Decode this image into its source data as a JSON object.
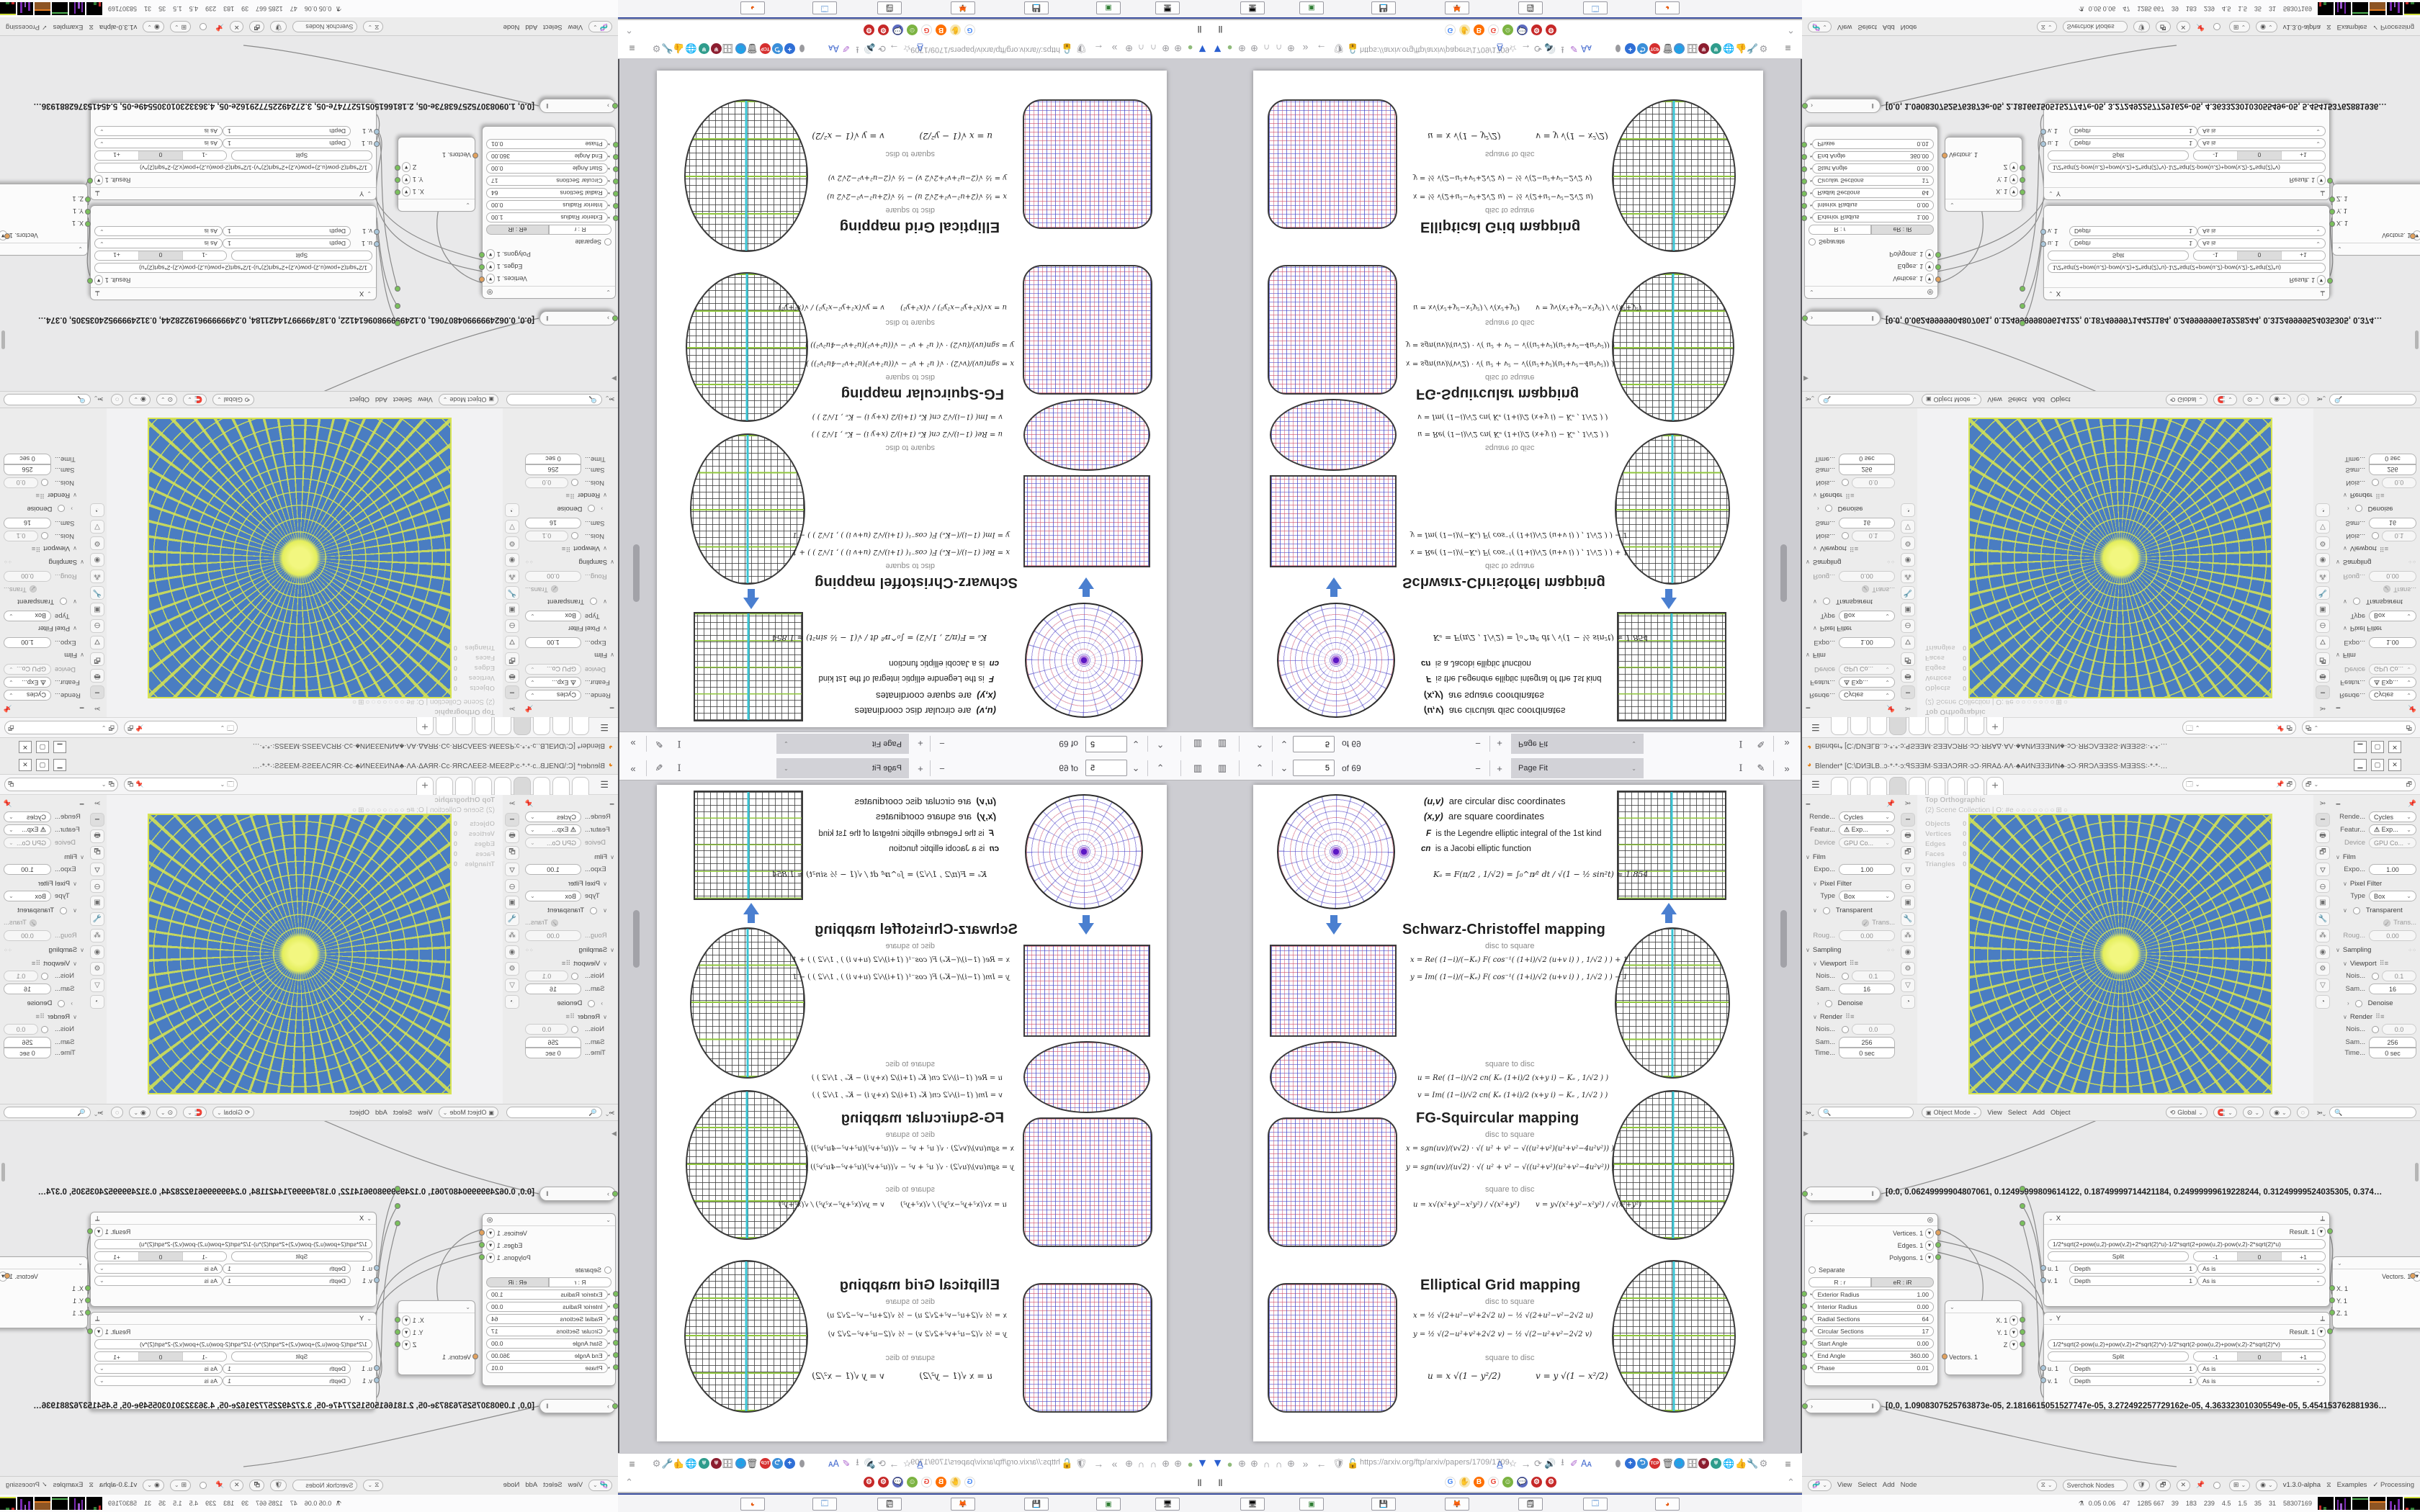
{
  "pdf": {
    "toolbar": {
      "page_value": "5",
      "page_total": "of 69",
      "zoom_mode": "Page Fit"
    },
    "url": "https://arxiv.org/ftp/arxiv/papers/1709/1709.",
    "paper": {
      "intro": [
        {
          "term": "(u,v)",
          "rest": "are circular disc coordinates"
        },
        {
          "term": "(x,y)",
          "rest": "are square coordinates"
        },
        {
          "term": "F",
          "rest": "is the Legendre elliptic integral of the 1st kind"
        },
        {
          "term": "cn",
          "rest": "is a Jacobi elliptic function"
        }
      ],
      "ke_equation": "Kₑ =  F(π∕2 , 1∕√2) = ∫₀^π⁄²  dt ∕ √(1 − ½ sin²t)  ≈ 1.854",
      "sections": [
        {
          "title": "Schwarz-Christoffel mapping",
          "d2s_label": "disc to square",
          "s2d_label": "square to disc",
          "d2s": [
            "x = Re( (1−i)∕(−Kₑ) F( cos⁻¹( (1+i)∕√2 (u+v i) ) , 1∕√2 ) ) + 1",
            "y = Im( (1−i)∕(−Kₑ) F( cos⁻¹( (1+i)∕√2 (u+v i) ) , 1∕√2 ) ) − 1"
          ],
          "s2d": [
            "u = Re( (1−i)∕√2  cn( Kₑ (1+i)∕2 (x+y i) − Kₑ , 1∕√2 ) )",
            "v = Im( (1−i)∕√2  cn( Kₑ (1+i)∕2 (x+y i) − Kₑ , 1∕√2 ) )"
          ]
        },
        {
          "title": "FG-Squircular mapping",
          "d2s_label": "disc to square",
          "s2d_label": "square to disc",
          "d2s": [
            "x = sgn(uv)∕(v√2) · √( u² + v² − √((u²+v²)(u²+v²−4u²v²)) )",
            "y = sgn(uv)∕(u√2) · √( u² + v² − √((u²+v²)(u²+v²−4u²v²)) )"
          ],
          "s2d": [
            "u = x√(x²+y²−x²y²) ∕ √(x²+y²)",
            "v = y√(x²+y²−x²y²) ∕ √(x²+y²)"
          ]
        },
        {
          "title": "Elliptical Grid mapping",
          "d2s_label": "disc to square",
          "s2d_label": "square to disc",
          "d2s": [
            "x = ½ √(2+u²−v²+2√2 u)  −  ½ √(2+u²−v²−2√2 u)",
            "y = ½ √(2−u²+v²+2√2 v)  −  ½ √(2−u²+v²−2√2 v)"
          ],
          "s2d": [
            "u = x √(1 − y²∕2)",
            "v = y √(1 − x²∕2)"
          ]
        }
      ]
    },
    "toolbar_icon_names": [
      "v-logo",
      "green-globe",
      "globe",
      "globe",
      "headset",
      "headset",
      "globe",
      "overflow-chevrons",
      "back-arrow",
      "shield",
      "lock",
      "translate",
      "bookmark-star",
      "forward-arrow",
      "reload",
      "speaker",
      "download",
      "highlighter",
      "translate-picker",
      "mouse",
      "add",
      "return",
      "tcp",
      "trash",
      "globe-color",
      "archive",
      "shield-red",
      "shield-teal",
      "globe-gray",
      "thumbs-up",
      "wrench",
      "gear",
      "menu"
    ],
    "bookmark_icon_names": [
      "pause",
      "google",
      "hand",
      "blogger",
      "google2",
      "smiley",
      "chat",
      "gear-red-1",
      "gear-red-2",
      "collapse-caret"
    ]
  },
  "taskbar": {
    "buttons": [
      "screenshot-tool",
      "console-green",
      "floppy-64",
      "firefox",
      "notepad",
      "window-app",
      "blender"
    ]
  },
  "blender": {
    "title": "Blender* [C:\\DИƎLB..ɔ·*·*·ɔ:ꟼSƎƎM·SƎƎΛƆЯR·ɔƆ·ЯRAΔ·AΛ·♣AИNƎꞫƎИN♣·ɔƆ·ЯRƆΛƎƎSS·MƎƎSS꞉·*·*·…",
    "window_buttons": {
      "min": "▁",
      "max": "▢",
      "close": "✕"
    },
    "overlay": {
      "line1": "Top Orthographic",
      "line2": "(2) Scene Collection | O: #e",
      "stats": [
        [
          "Objects",
          "0 / 53"
        ],
        [
          "Vertices",
          "0"
        ],
        [
          "Edges",
          "0"
        ],
        [
          "Faces",
          "0"
        ],
        [
          "Triangles",
          "0"
        ]
      ]
    },
    "props": {
      "engine_label": "Rende...",
      "engine": "Cycles",
      "feature_label": "Featur...",
      "feature": "Exp...",
      "device_label": "Device",
      "device": "GPU Co...",
      "film": "Film",
      "exposure_label": "Expo...",
      "exposure": "1.00",
      "pixel_filter": "Pixel Filter",
      "type_label": "Type",
      "type": "Box",
      "transparent": "Transparent",
      "trans": "Trans...",
      "rough_label": "Roug...",
      "rough": "0.00",
      "sampling": "Sampling",
      "viewport": "Viewport",
      "noise_v_label": "Nois...",
      "noise_v": "0.1",
      "samples_v_label": "Sam...",
      "samples_v": "16",
      "denoise": "Denoise",
      "render": "Render",
      "noise_r_label": "Nois...",
      "noise_r": "0.0",
      "samples_r_label": "Sam...",
      "samples_r": "256",
      "time_label": "Time...",
      "time": "0 sec"
    },
    "vp_header": {
      "mode": "Object Mode",
      "menus": [
        "View",
        "Select",
        "Add",
        "Object"
      ],
      "orientation": "Global"
    },
    "node_editor": {
      "array1": "[0.0, 0.06249999904807061, 0.12499999809614122, 0.18749999714421184, 0.24999999619228244, 0.31249999524035305, 0.374…",
      "array2": "[0.0, 1.0908307525763873e-05, 2.1816615051527747e-05, 3.272492257729162e-05, 4.363323010305549e-05, 5.454153762881936…",
      "circle_node": {
        "outputs": [
          [
            "Vertices. 1"
          ],
          [
            "Edges. 1"
          ],
          [
            "Polygons. 1"
          ]
        ],
        "separate": "Separate",
        "btn_a": "R : r",
        "btn_b": "eR : iR",
        "params": [
          [
            "Exterior Radius",
            "1.00"
          ],
          [
            "Interior Radius",
            "0.00"
          ],
          [
            "Radial Sections",
            "64"
          ],
          [
            "Circular Sections",
            "17"
          ],
          [
            "Start Angle",
            "0.00"
          ],
          [
            "End Angle",
            "360.00"
          ],
          [
            "Phase",
            "0.01"
          ]
        ]
      },
      "x_node": {
        "name": "X",
        "result": "Result. 1",
        "formula": "1/2*sqrt(2+pow(u,2)-pow(v,2)+2*sqrt(2)*u)-1/2*sqrt(2+pow(u,2)-pow(v,2)-2*sqrt(2)*u)",
        "split": "Split",
        "seg": [
          "-1",
          "0",
          "+1"
        ],
        "u": "u. 1",
        "v": "v. 1",
        "depth": "Depth",
        "depth_val": "1",
        "asis": "As is"
      },
      "y_node": {
        "name": "Y",
        "result": "Result. 1",
        "formula": "1/2*sqrt(2-pow(u,2)+pow(v,2)+2*sqrt(2)*v)-1/2*sqrt(2-pow(u,2)+pow(v,2)-2*sqrt(2)*v)",
        "split": "Split",
        "seg": [
          "-1",
          "0",
          "+1"
        ],
        "u": "u. 1",
        "v": "v. 1",
        "depth": "Depth",
        "depth_val": "1",
        "asis": "As is"
      },
      "vec_out": {
        "x": "X. 1",
        "y": "Y. 1",
        "z": "Z",
        "vectors": "Vectors. 1"
      },
      "vec_in": {
        "vectors": "Vectors. 1",
        "x": "X. 1",
        "y": "Y. 1",
        "z": "Z. 1"
      },
      "header": {
        "menus": [
          "View",
          "Select",
          "Add",
          "Node"
        ],
        "tree": "Sverchok Nodes",
        "version": "v1.3.0-alpha",
        "examples": "Examples",
        "processing": "Processing"
      }
    },
    "status": "0.05 0.06    47    1285 667    39    183    239    4.5    1.5    35    31    58307169"
  }
}
